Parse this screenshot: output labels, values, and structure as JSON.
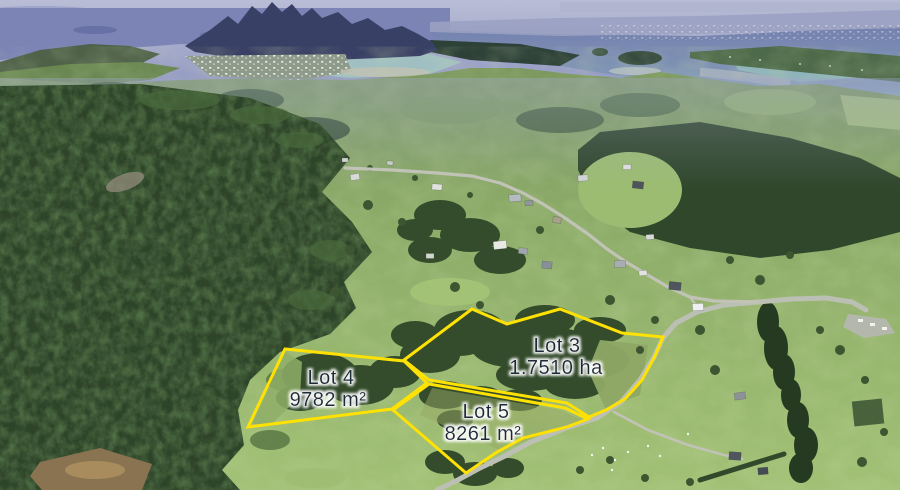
{
  "scene": {
    "type": "aerial-drone-photo",
    "description": "Aerial view of rural coastal farmland: dark native forest at left, green paddocks with houses and a winding road at right, a wide blue harbour, township and mountain range in the distance. Three subdivision lots are outlined in yellow."
  },
  "overlay": {
    "annotation_color": "#ffe103",
    "label_text_color": "#1e2a38",
    "label_halo_color": "#ffffff"
  },
  "lots": [
    {
      "name": "Lot 3",
      "area": "1.7510 ha"
    },
    {
      "name": "Lot 4",
      "area": "9782 m²"
    },
    {
      "name": "Lot 5",
      "area": "8261 m²"
    }
  ]
}
